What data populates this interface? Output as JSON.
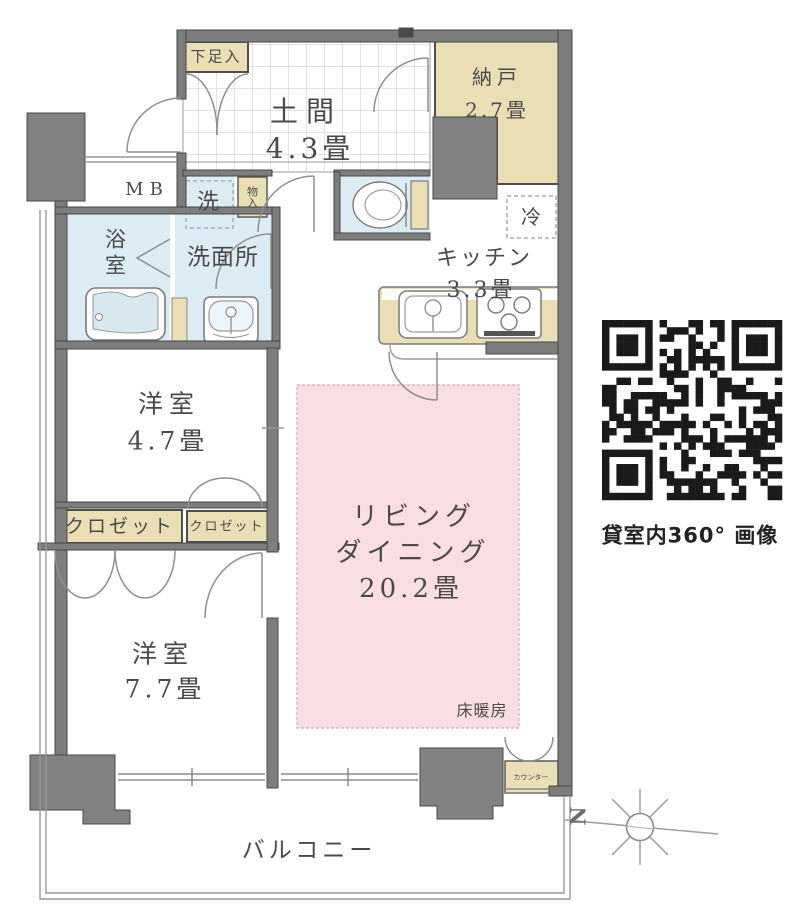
{
  "rooms": {
    "shoe_cabinet": {
      "label": "下足入"
    },
    "doma": {
      "name": "土間",
      "size": "4.3畳"
    },
    "nando": {
      "name": "納戸",
      "size": "2.7畳"
    },
    "meter_box": {
      "label": "MB"
    },
    "laundry": {
      "label": "洗"
    },
    "storage": {
      "label": "物入"
    },
    "bathroom": {
      "label": "浴室"
    },
    "washroom": {
      "label": "洗面所"
    },
    "refrigerator": {
      "label": "冷"
    },
    "kitchen": {
      "name": "キッチン",
      "size": "3.3畳"
    },
    "bedroom1": {
      "name": "洋室",
      "size": "4.7畳"
    },
    "living_dining": {
      "name_line1": "リビング",
      "name_line2": "ダイニング",
      "size": "20.2畳"
    },
    "floor_heating": {
      "label": "床暖房"
    },
    "closet_left": {
      "label": "クロゼット"
    },
    "closet_right": {
      "label": "クロゼット"
    },
    "bedroom2": {
      "name": "洋室",
      "size": "7.7畳"
    },
    "counter": {
      "label": "カウンター"
    },
    "balcony": {
      "label": "バルコニー"
    }
  },
  "qr": {
    "caption": "貸室内360° 画像"
  },
  "compass": {
    "north": "N"
  },
  "colors": {
    "wall_gray": "#7d7d7d",
    "pillar_gray": "#828282",
    "storage_tan": "#eadfb4",
    "water_blue": "#dcecf4",
    "floor_heating_pink": "#f9dee3",
    "qr_black": "#1a1a1a",
    "text_gray": "#4a4a4a"
  }
}
